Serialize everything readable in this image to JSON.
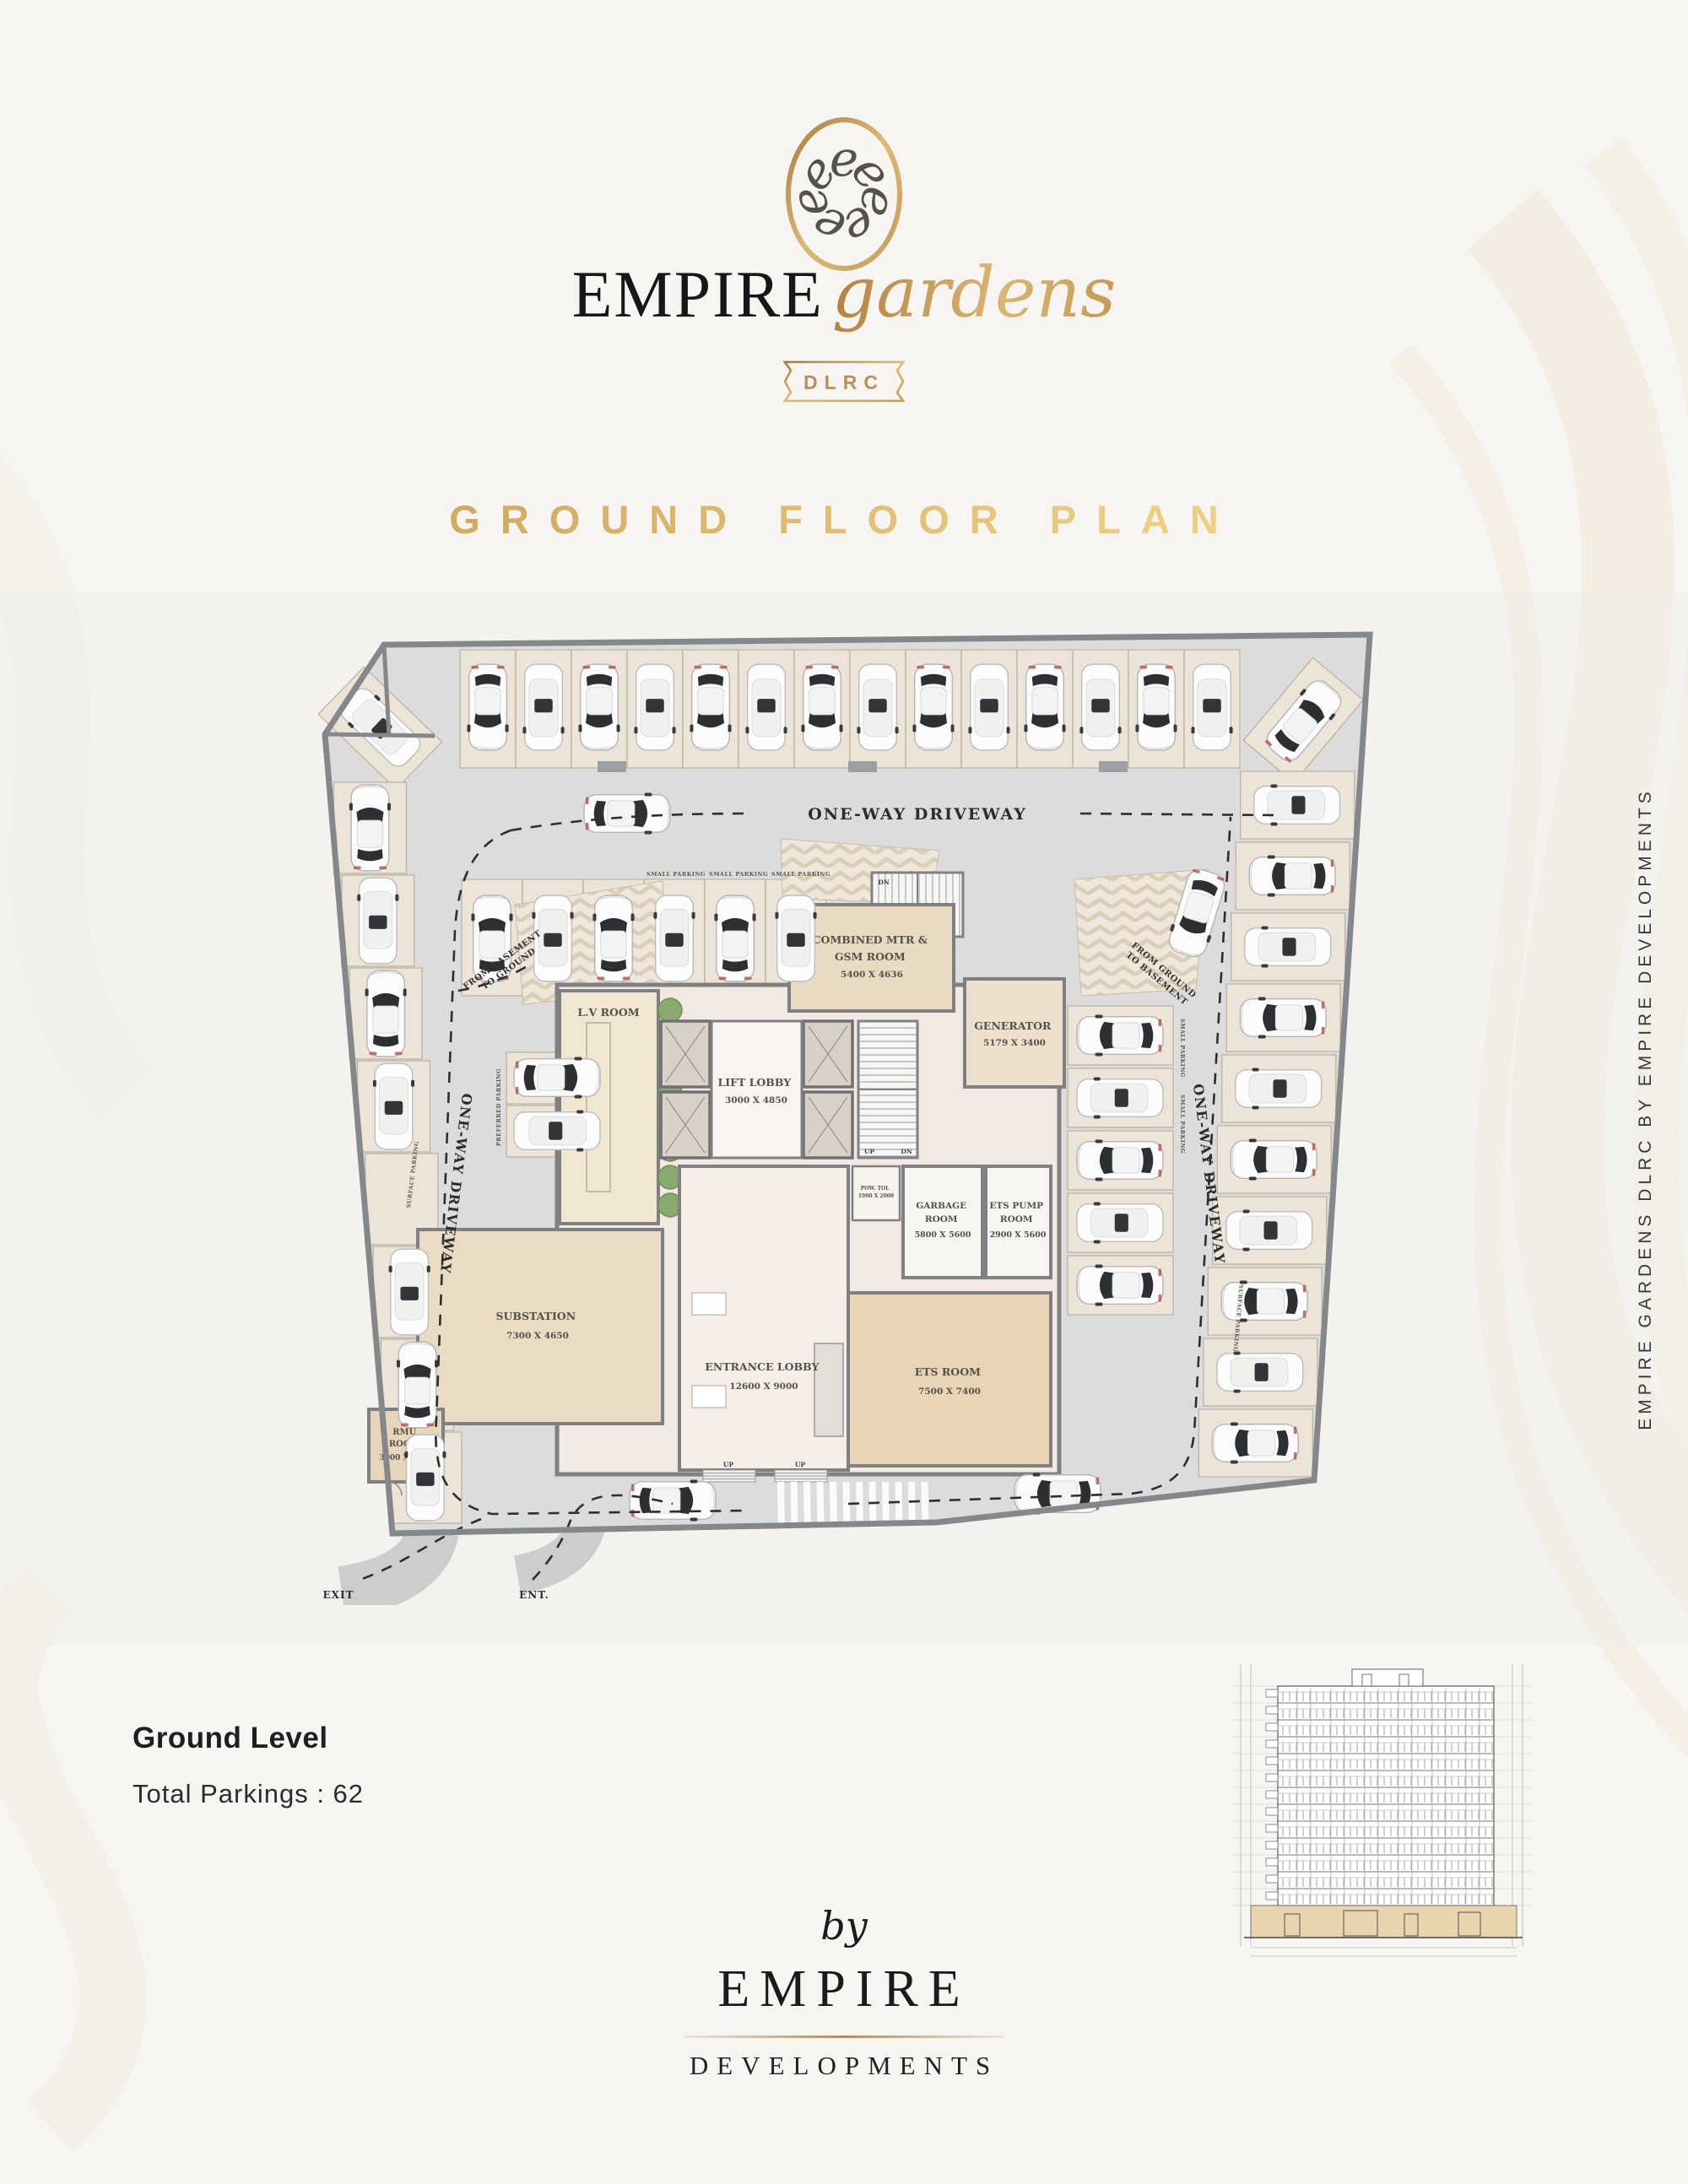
{
  "header": {
    "monogram_icon": "empire-gardens-monogram",
    "brand_primary": "EMPIRE",
    "brand_script": "gardens",
    "badge": "DLRC",
    "page_title": "GROUND FLOOR PLAN"
  },
  "plan": {
    "labels": {
      "one_way": "ONE-WAY DRIVEWAY",
      "from_basement_1": "FROM BASEMENT",
      "from_basement_2": "TO GROUND",
      "from_ground_1": "FROM GROUND",
      "from_ground_2": "TO BASEMENT",
      "exit": "EXIT",
      "ent": "ENT.",
      "small_parking": "SMALL PARKING",
      "surface_parking": "SURFACE PARKING",
      "preferred_parking": "PREFERRED PARKING",
      "up": "UP",
      "dn": "DN"
    },
    "rooms": {
      "lv": {
        "name": "L.V ROOM"
      },
      "mtr": {
        "name": "COMBINED MTR &",
        "name2": "GSM ROOM",
        "dims": "5400 X 4636"
      },
      "generator": {
        "name": "GENERATOR",
        "dims": "5179 X 3400"
      },
      "lift": {
        "name": "LIFT LOBBY",
        "dims": "3000 X 4850"
      },
      "garbage": {
        "name": "GARBAGE",
        "name2": "ROOM",
        "dims": "5800 X 5600"
      },
      "etspump": {
        "name": "ETS PUMP",
        "name2": "ROOM",
        "dims": "2900 X 5600"
      },
      "ets": {
        "name": "ETS ROOM",
        "dims": "7500 X 7400"
      },
      "substation": {
        "name": "SUBSTATION",
        "dims": "7300 X 4650"
      },
      "entrance": {
        "name": "ENTRANCE LOBBY",
        "dims": "12600 X 9000"
      },
      "rmu": {
        "name": "RMU",
        "name2": "ROOM",
        "dims": "3000 X 3000"
      },
      "powder": {
        "name": "POW. TOI.",
        "dims": "1900 X 2000"
      }
    },
    "total_cars_shown": "62"
  },
  "side_caption": "EMPIRE GARDENS DLRC BY EMPIRE DEVELOPMENTS",
  "footer": {
    "level_title": "Ground Level",
    "parkings_label": "Total Parkings : 62",
    "by": "by",
    "brand": "EMPIRE",
    "brand_sub": "DEVELOPMENTS"
  }
}
